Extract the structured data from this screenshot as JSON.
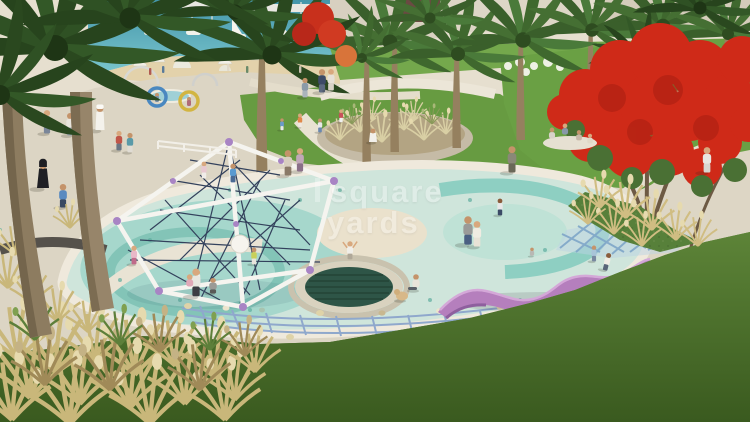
{
  "image_type": "architectural-render",
  "watermark": {
    "line1": "square",
    "line2": "yards"
  },
  "palette": {
    "water": "#55aebd",
    "sand": "#e3d2ab",
    "plaza": "#dcd5c4",
    "lawn": "#679b41",
    "lawn_right": "#6aa044",
    "pad_base": "#cfe5db",
    "pad_aqua": "#a6d7cc",
    "pad_cream": "#eae1cc",
    "trampoline": "#2e5547",
    "slide_purple": "#b57fbd",
    "flame_red": "#cf2a18",
    "structure_white": "#f5f4ef",
    "structure_node": "#a884c4",
    "net_rope": "#33415c",
    "ground_net": "#8fa8cc",
    "dry_grass": "#c9b77a",
    "foreground_grass": "#4e7a2f",
    "walkway": "#ddd6c5"
  },
  "scene": {
    "setting": "waterfront community park playground",
    "objects": [
      "marina with sailboats",
      "beach umbrellas",
      "palm trees",
      "red flame tree",
      "geodesic rope climbing frame",
      "in-ground trampoline",
      "splash pad",
      "purple wave slide",
      "rope ground net",
      "ornamental grass planter",
      "picnic group",
      "ring swings"
    ]
  }
}
